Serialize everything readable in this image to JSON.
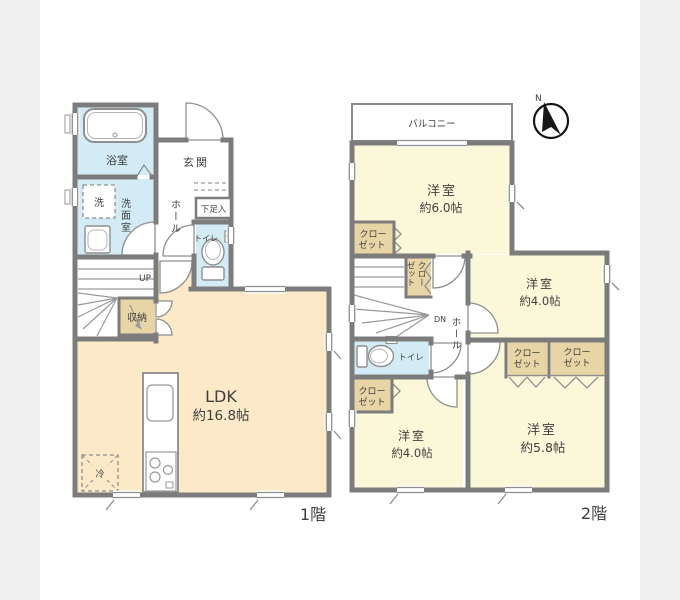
{
  "colors": {
    "wall": "#7c7c7c",
    "room_cream": "#fbe9c8",
    "room_yellow": "#fbf8d9",
    "wet_blue": "#d3ebf4",
    "closet_tan": "#e8d5a5",
    "bg_side": "#f0f0f0",
    "canvas": "#ffffff",
    "text": "#3f3f3f"
  },
  "floor1": {
    "floor_label": "1階",
    "bath": "浴室",
    "washer": "洗",
    "washroom": "洗面室",
    "entrance": "玄関",
    "hall": "ホール",
    "shoe_cabinet": "下足入",
    "toilet": "トイレ",
    "stairs": "UP",
    "storage": "収納",
    "ldk_name": "LDK",
    "ldk_size": "約16.8帖",
    "fridge": "冷"
  },
  "floor2": {
    "floor_label": "2階",
    "balcony": "バルコニー",
    "bedroom_a_name": "洋室",
    "bedroom_a_size": "約6.0帖",
    "bedroom_b_name": "洋室",
    "bedroom_b_size": "約4.0帖",
    "bedroom_c_name": "洋室",
    "bedroom_c_size": "約4.0帖",
    "bedroom_d_name": "洋室",
    "bedroom_d_size": "約5.8帖",
    "closet_line1": "クロー",
    "closet_line2": "ゼット",
    "hall": "ホール",
    "toilet": "トイレ",
    "stairs": "DN",
    "compass_north": "N"
  }
}
